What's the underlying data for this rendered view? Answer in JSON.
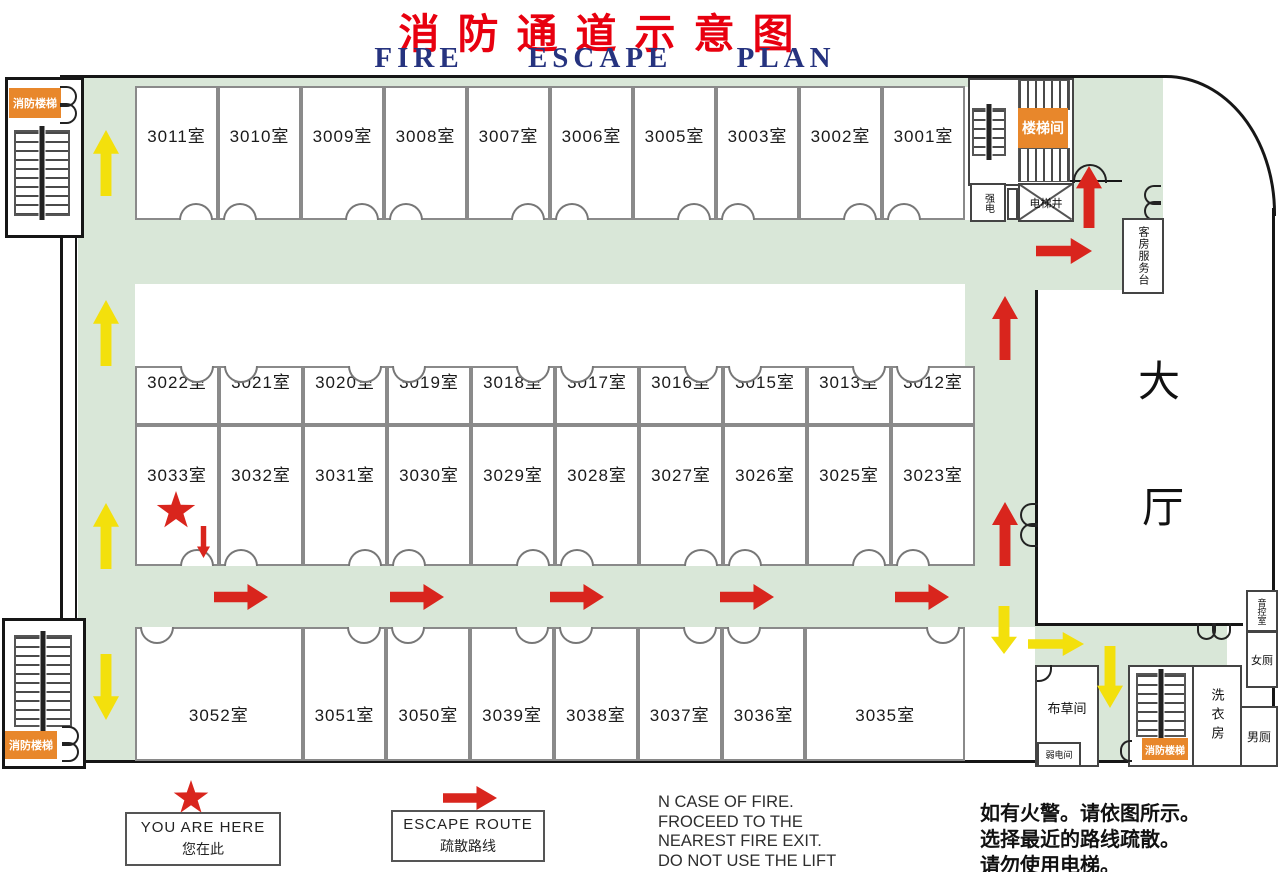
{
  "title": {
    "zh": "消防通道示意图",
    "en": "FIRE ESCAPE PLAN"
  },
  "rooms": {
    "row1": [
      "3011室",
      "3010室",
      "3009室",
      "3008室",
      "3007室",
      "3006室",
      "3005室",
      "3003室",
      "3002室",
      "3001室"
    ],
    "row2": [
      "3022室",
      "3021室",
      "3020室",
      "3019室",
      "3018室",
      "3017室",
      "3016室",
      "3015室",
      "3013室",
      "3012室"
    ],
    "row3": [
      "3033室",
      "3032室",
      "3031室",
      "3030室",
      "3029室",
      "3028室",
      "3027室",
      "3026室",
      "3025室",
      "3023室"
    ],
    "row4": [
      "3052室",
      "3051室",
      "3050室",
      "3039室",
      "3038室",
      "3037室",
      "3036室",
      "3035室"
    ]
  },
  "labels": {
    "fire_stairs_top_left": "消防楼梯",
    "fire_stairs_bottom_left": "消防楼梯",
    "fire_stairs_bottom_right": "消防楼梯",
    "stairwell": "楼梯间",
    "strong_power": "强电",
    "elevator_shaft": "电梯井",
    "room_service_desk": "客房服务台",
    "lobby_char1": "大",
    "lobby_char2": "厅",
    "sound_control": "音控室",
    "women_toilet": "女厕",
    "laundry": "洗衣房",
    "men_toilet": "男厕",
    "linen_room": "布草间",
    "weak_power": "弱电间"
  },
  "legend": {
    "you_are_here_en": "YOU ARE HERE",
    "you_are_here_zh": "您在此",
    "escape_route_en": "ESCAPE ROUTE",
    "escape_route_zh": "疏散路线"
  },
  "notes": {
    "en": [
      "N CASE OF FIRE.",
      "FROCEED TO THE",
      "NEAREST FIRE EXIT.",
      "DO NOT USE THE LIFT"
    ],
    "zh": [
      "如有火警。请依图所示。",
      "选择最近的路线疏散。",
      "请勿使用电梯。"
    ]
  },
  "colors": {
    "corridor_green": "#d9e7d8",
    "escape_red": "#d9251d",
    "escape_yellow": "#f3e00c",
    "label_orange": "#e8872b",
    "title_red": "#e8000f",
    "title_blue": "#26337f"
  }
}
